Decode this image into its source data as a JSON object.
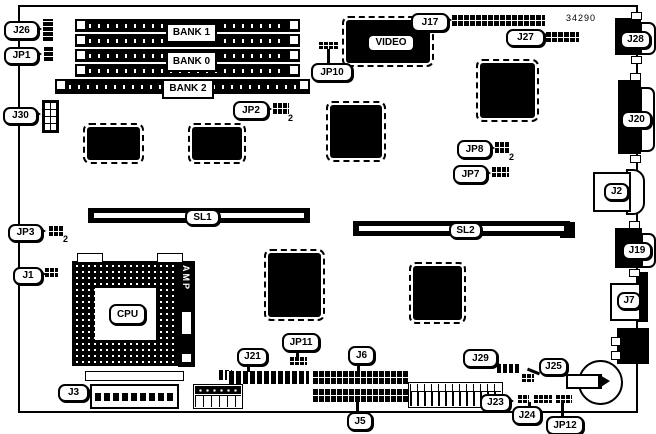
{
  "title": {
    "part_number": "34290"
  },
  "labels": {
    "j26": "J26",
    "jp1": "JP1",
    "j30": "J30",
    "jp3": "JP3",
    "j1": "J1",
    "j3": "J3",
    "jp10": "JP10",
    "jp2": "JP2",
    "j17": "J17",
    "j27": "J27",
    "j28": "J28",
    "j20": "J20",
    "j2": "J2",
    "j19": "J19",
    "j7": "J7",
    "jp8": "JP8",
    "jp7": "JP7",
    "bank1": "BANK 1",
    "bank0": "BANK 0",
    "bank2": "BANK 2",
    "video": "VIDEO",
    "sl1": "SL1",
    "sl2": "SL2",
    "cpu": "CPU",
    "amp": "AMP",
    "j21": "J21",
    "jp11": "JP11",
    "j6": "J6",
    "j5": "J5",
    "j29": "J29",
    "j25": "J25",
    "j23": "J23",
    "j24": "J24",
    "jp12": "JP12",
    "pin2": "2"
  }
}
